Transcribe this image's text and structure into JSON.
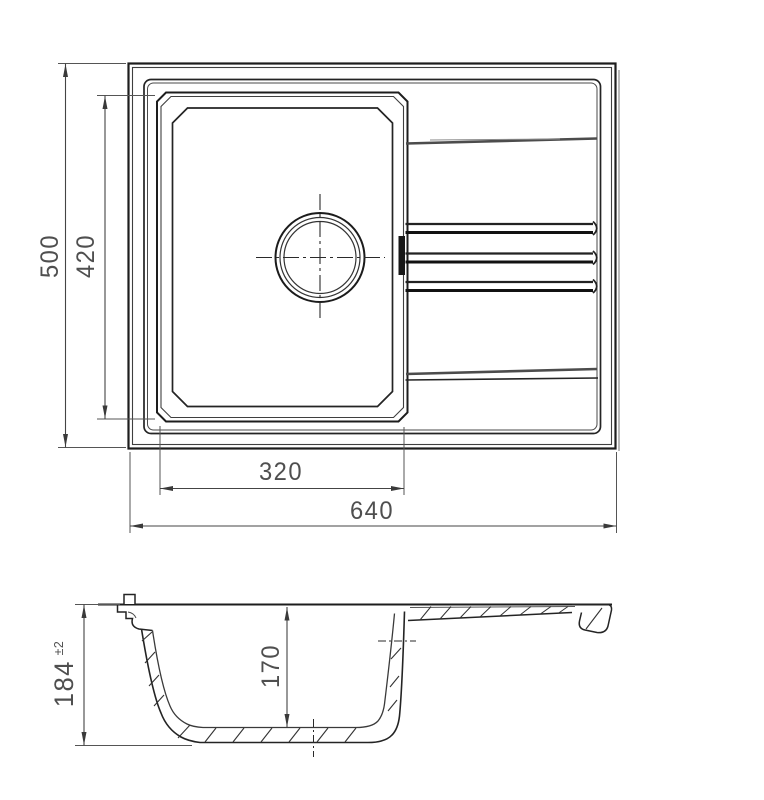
{
  "drawing": {
    "kind": "sink-technical-drawing",
    "views": {
      "top_view_name": "top-view",
      "section_view_name": "section-view"
    }
  },
  "dimensions": {
    "top_view": {
      "overall_width": "640",
      "overall_depth": "500",
      "bowl_width": "320",
      "bowl_depth": "420"
    },
    "section_view": {
      "overall_height": "184",
      "overall_height_tolerance": "±2",
      "bowl_inner_depth": "170"
    }
  },
  "colors": {
    "line_main": "#1d1d1d",
    "line_secondary": "#3f3f3f",
    "line_soft": "#555555",
    "line_shade": "#a8a8a8",
    "dim_text": "#4f4f4f",
    "background": "#ffffff"
  }
}
